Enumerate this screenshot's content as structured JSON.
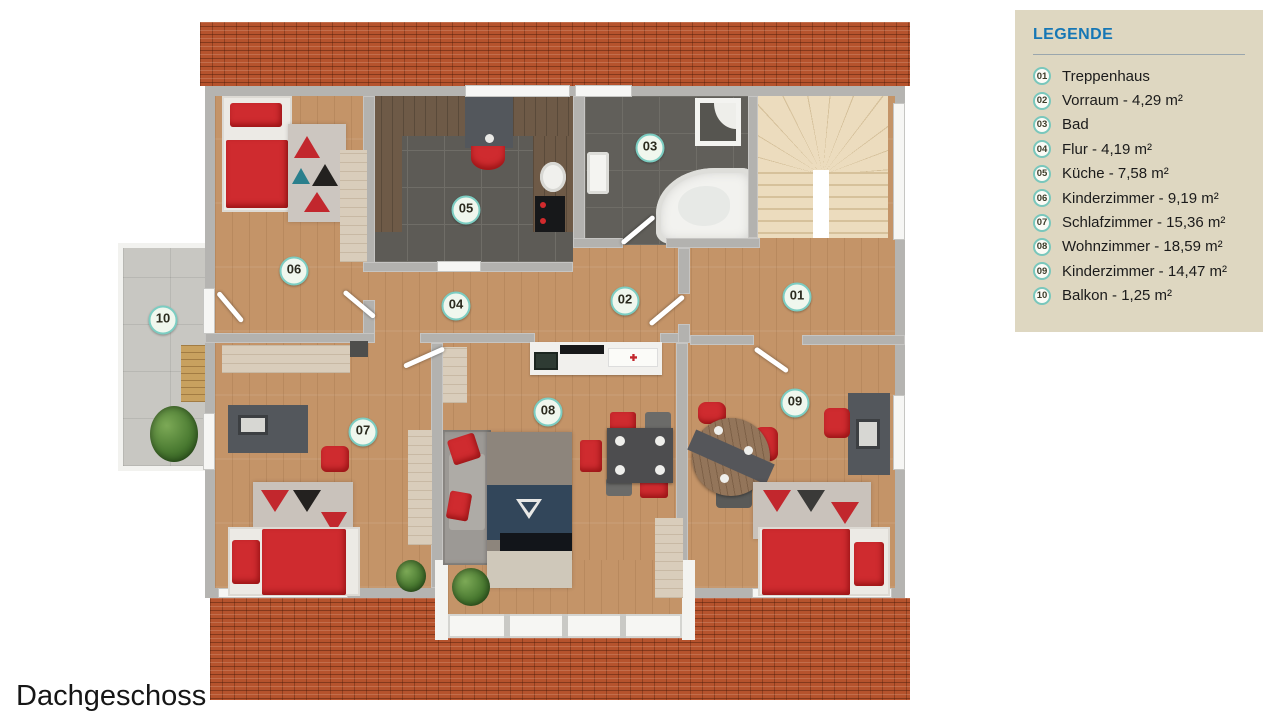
{
  "floor_label": "Dachgeschoss",
  "legend": {
    "title": "LEGENDE",
    "items": [
      {
        "num": "01",
        "label": "Treppenhaus"
      },
      {
        "num": "02",
        "label": "Vorraum - 4,29 m²"
      },
      {
        "num": "03",
        "label": "Bad"
      },
      {
        "num": "04",
        "label": "Flur - 4,19 m²"
      },
      {
        "num": "05",
        "label": "Küche - 7,58 m²"
      },
      {
        "num": "06",
        "label": "Kinderzimmer - 9,19 m²"
      },
      {
        "num": "07",
        "label": "Schlafzimmer - 15,36 m²"
      },
      {
        "num": "08",
        "label": "Wohnzimmer - 18,59 m²"
      },
      {
        "num": "09",
        "label": "Kinderzimmer - 14,47 m²"
      },
      {
        "num": "10",
        "label": "Balkon - 1,25 m²"
      }
    ]
  },
  "plan": {
    "room_markers": [
      {
        "num": "01",
        "room": "Treppenhaus"
      },
      {
        "num": "02",
        "room": "Vorraum"
      },
      {
        "num": "03",
        "room": "Bad"
      },
      {
        "num": "04",
        "room": "Flur"
      },
      {
        "num": "05",
        "room": "Küche"
      },
      {
        "num": "06",
        "room": "Kinderzimmer"
      },
      {
        "num": "07",
        "room": "Schlafzimmer"
      },
      {
        "num": "08",
        "room": "Wohnzimmer"
      },
      {
        "num": "09",
        "room": "Kinderzimmer"
      },
      {
        "num": "10",
        "room": "Balkon"
      }
    ],
    "colors": {
      "roof": "#b6532d",
      "wall": "#b5b4b1",
      "wood_floor": "#c49468",
      "tile_floor": "#5d5b56",
      "stairs": "#ecdcbe",
      "balcony_floor": "#c8c7c2",
      "accent_red": "#cf2b2f",
      "marker_ring": "#7ccdc2",
      "legend_bg": "#ded7c1",
      "legend_title": "#1677b5"
    }
  }
}
